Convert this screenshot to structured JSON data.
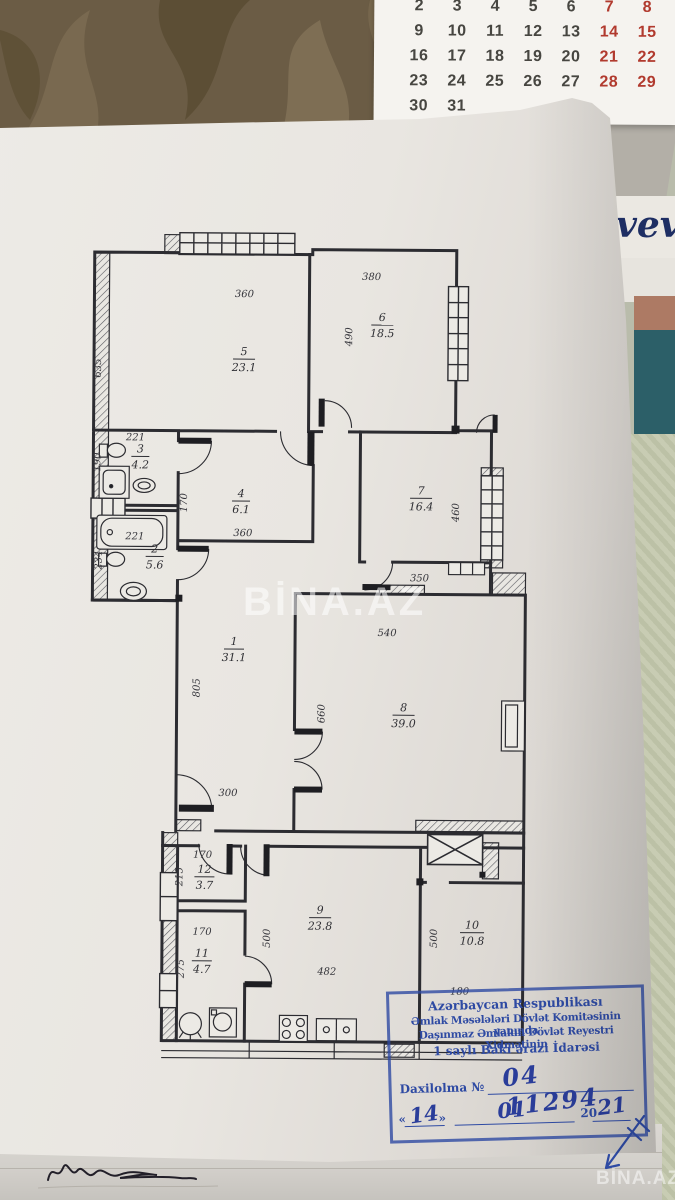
{
  "calendar": {
    "rows": [
      [
        "2",
        "3",
        "4",
        "5",
        "6",
        "7",
        "8"
      ],
      [
        "9",
        "10",
        "11",
        "12",
        "13",
        "14",
        "15"
      ],
      [
        "16",
        "17",
        "18",
        "19",
        "20",
        "21",
        "22"
      ],
      [
        "23",
        "24",
        "25",
        "26",
        "27",
        "28",
        "29"
      ],
      [
        "30",
        "31"
      ]
    ],
    "weekday_color": "#474641",
    "weekend_color": "#b13a2e"
  },
  "background": {
    "box_text": "vev"
  },
  "watermark": {
    "text": "BİNA.AZ"
  },
  "plan": {
    "rooms": [
      {
        "n": "1",
        "a": "31.1",
        "dims": {
          "left": "805",
          "bottom": "300"
        }
      },
      {
        "n": "2",
        "a": "5.6",
        "dims": {
          "inner": "221",
          "left": "234"
        }
      },
      {
        "n": "3",
        "a": "4.2",
        "dims": {
          "top": "221",
          "left": "190"
        }
      },
      {
        "n": "4",
        "a": "6.1",
        "dims": {
          "left": "170",
          "bottom": "360"
        }
      },
      {
        "n": "5",
        "a": "23.1",
        "dims": {
          "top": "360",
          "left": "635"
        }
      },
      {
        "n": "6",
        "a": "18.5",
        "dims": {
          "top": "380",
          "left": "490"
        }
      },
      {
        "n": "7",
        "a": "16.4",
        "dims": {
          "right": "460",
          "bottom": "350"
        }
      },
      {
        "n": "8",
        "a": "39.0",
        "dims": {
          "top": "540",
          "left": "660"
        }
      },
      {
        "n": "9",
        "a": "23.8",
        "dims": {
          "left": "500",
          "bottom": "482"
        }
      },
      {
        "n": "10",
        "a": "10.8",
        "dims": {
          "left": "500",
          "bottom": "180"
        }
      },
      {
        "n": "11",
        "a": "4.7",
        "dims": {
          "top": "170",
          "left": "275"
        }
      },
      {
        "n": "12",
        "a": "3.7",
        "dims": {
          "top": "170",
          "left": "215"
        }
      }
    ]
  },
  "stamp": {
    "line1": "Azərbaycan Respublikası",
    "line2": "Əmlak Məsələləri Dövlət Komitəsinin yanında",
    "line3": "Daşınmaz Əmlakın Dövlət Reyestri Xidmətinin",
    "line4": "1 saylı Bakı ərazi İdarəsi",
    "entry_label": "Daxilolma №",
    "entry_number": "04 11294",
    "q1": "«",
    "q2": "»",
    "day": "14",
    "month": "01",
    "year_prefix": "20",
    "year": "21"
  }
}
